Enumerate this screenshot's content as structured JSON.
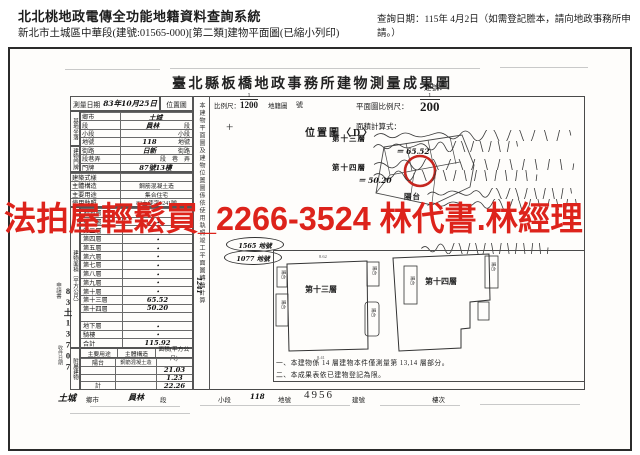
{
  "ad": {
    "text": "法拍屋輕鬆買_2266-3524 林代書.林經理",
    "color": "#dd231b"
  },
  "header": {
    "system": "北北桃地政電傳全功能地籍資料查詢系統",
    "doc": "新北市土城區中華段(建號:01565-000)[第二類]建物平面圖(已縮小列印)",
    "query": "查詢日期：115年 4月2日（如需登記謄本，請向地政事務所申請。）"
  },
  "form": {
    "title": "臺北縣板橋地政事務所建物測量成果圖",
    "building_no_label": "建號：",
    "no_suffix": "號",
    "survey": {
      "label": "測量日期",
      "value": "83年10月25日"
    },
    "loc_map": {
      "cell": "位置圖",
      "scale_label": "比例尺：",
      "num": "1",
      "den": "1200",
      "suffix": "地籍圖",
      "map_title": "位置圖〈D〉",
      "cross": "+"
    },
    "plan_scale": {
      "label": "平面圖比例尺：",
      "num": "1",
      "den": "200"
    },
    "calc_label": "面積計算式：",
    "calc": [
      {
        "label": "第十三層",
        "result": "＝ 65.52"
      },
      {
        "label": "第十四層",
        "result": "＝ 50.20"
      },
      {
        "label": "陽台",
        "result": ""
      }
    ],
    "groups": {
      "site": "基地坐落",
      "door": "建物門牌",
      "area": "建物面積（平方公尺）",
      "annex": "附屬建物"
    },
    "site_rows": [
      {
        "l": "鄉市",
        "v": "土城",
        "s": ""
      },
      {
        "l": "段",
        "v": "員林",
        "s": "段"
      },
      {
        "l": "小段",
        "v": "",
        "s": "小段"
      },
      {
        "l": "地號",
        "v": "118",
        "s": "地號"
      },
      {
        "l": "街路",
        "v": "日新",
        "s": "街路"
      },
      {
        "l": "段巷弄",
        "v": "",
        "s": "段　巷　弄"
      },
      {
        "l": "門牌",
        "v": "87號13樓",
        "s": ""
      }
    ],
    "attr_rows": [
      {
        "l": "建築式樣",
        "v": ""
      },
      {
        "l": "主體構造",
        "v": "鋼筋混凝土造"
      },
      {
        "l": "主要用途",
        "v": "集合住宅"
      },
      {
        "l": "使用執照",
        "v": "83土使字1241號"
      }
    ],
    "floors": [
      {
        "label": "地面層",
        "value": "・"
      },
      {
        "label": "第二層",
        "value": "・"
      },
      {
        "label": "第三層",
        "value": "・"
      },
      {
        "label": "第四層",
        "value": "・"
      },
      {
        "label": "第五層",
        "value": "・"
      },
      {
        "label": "第六層",
        "value": "・"
      },
      {
        "label": "第七層",
        "value": "・"
      },
      {
        "label": "第八層",
        "value": "・"
      },
      {
        "label": "第九層",
        "value": "・"
      },
      {
        "label": "第十層",
        "value": "・"
      },
      {
        "label": "第十三層",
        "value": "65.52"
      },
      {
        "label": "第十四層",
        "value": "50.20"
      },
      {
        "label": "",
        "value": ""
      },
      {
        "label": "地下層",
        "value": "・"
      },
      {
        "label": "騎樓",
        "value": "・"
      },
      {
        "label": "合計",
        "value": "115.92"
      }
    ],
    "annex_header": [
      "主要用途",
      "主體構造",
      "面積(平方公尺)"
    ],
    "annex_rows": [
      {
        "u": "陽台",
        "st": "鋼筋混凝土造",
        "a": ""
      },
      {
        "u": "",
        "st": "",
        "a": "21.03"
      },
      {
        "u": "",
        "st": "",
        "a": "1.23"
      },
      {
        "u": "計",
        "st": "",
        "a": "22.26"
      }
    ],
    "vertical_note": "本建物平面圖及建物位置圖係依使用執照竣工平面圖轉繪計算",
    "strip_hand": "1241",
    "left_stamp": {
      "form": "申請書",
      "no": "83土13707",
      "recv": "收件日期"
    },
    "ovals": [
      "1565 地號",
      "1077 地號"
    ],
    "plans": {
      "p13": "第十三層",
      "p14": "第十四層",
      "balcony": "陽台",
      "dim_top": "8.62",
      "dim_bottom": "8.41"
    },
    "notes": [
      "一、本建物係 14 層建物本件僅測量第 13,14 層部分。",
      "二、本成果表依已建物登記為限。"
    ],
    "footer": {
      "city": "土城",
      "city_l": "鄉市",
      "sec": "員林",
      "sec_l": "段",
      "sub_l": "小段",
      "parcel": "118",
      "parcel_l": "地號",
      "serial": "4956",
      "serial_l": "建號",
      "floor_l": "樓次"
    }
  }
}
